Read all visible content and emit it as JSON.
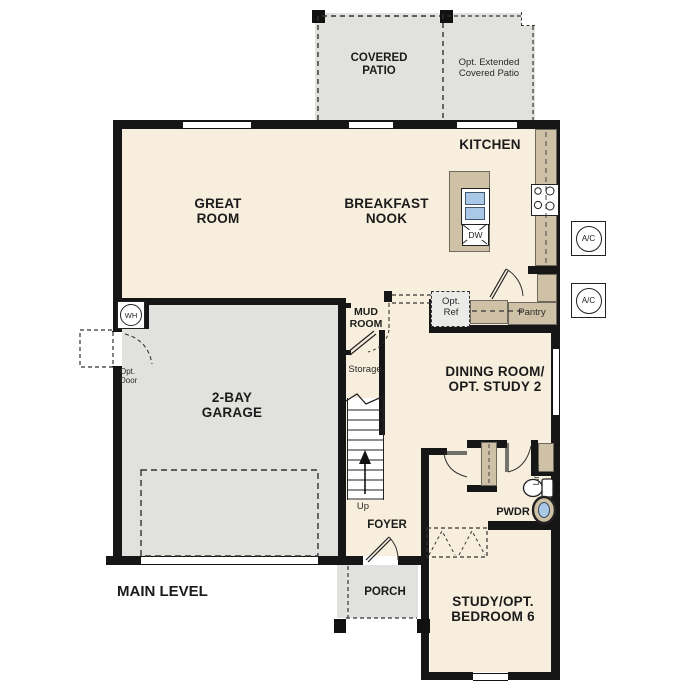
{
  "title": "MAIN LEVEL",
  "colors": {
    "interior_fill": "#f7eedd",
    "concrete_fill": "#e1e1de",
    "counter_fill": "#cfc1a6",
    "sink_blue": "#aac9e9",
    "wall": "#161616"
  },
  "labels": {
    "covered_patio": "COVERED PATIO",
    "opt_extended_patio": "Opt. Extended Covered Patio",
    "kitchen": "KITCHEN",
    "great_room": "GREAT ROOM",
    "breakfast_nook": "BREAKFAST NOOK",
    "mud_room": "MUD ROOM",
    "storage": "Storage",
    "up": "Up",
    "garage": "2-BAY GARAGE",
    "opt_door": "Opt. Door",
    "wh": "WH",
    "ac": "A/C",
    "dw": "DW",
    "opt_ref": "Opt. Ref",
    "dining": "DINING ROOM/ OPT. STUDY 2",
    "pantry": "Pantry",
    "linen": "Linen",
    "pwdr": "PWDR",
    "foyer": "FOYER",
    "porch": "PORCH",
    "study": "STUDY/OPT. BEDROOM 6",
    "main_level": "MAIN LEVEL"
  }
}
